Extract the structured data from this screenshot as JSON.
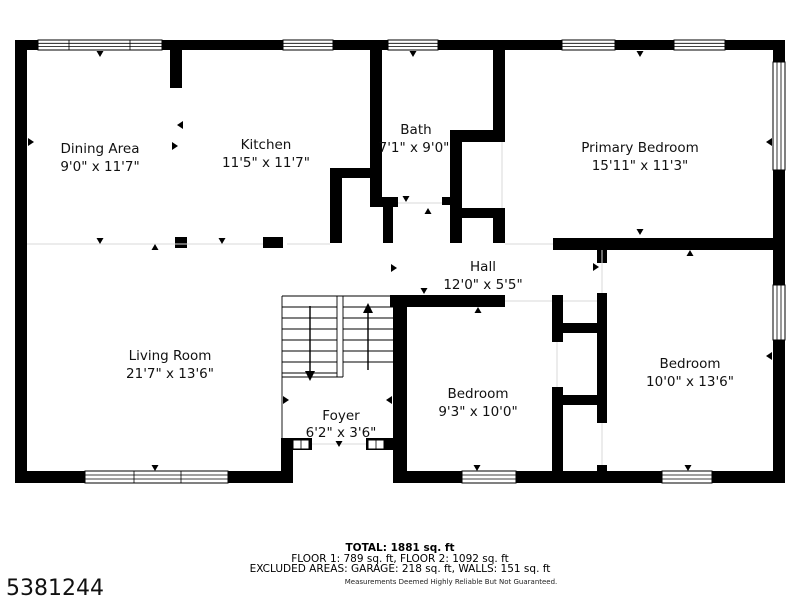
{
  "rooms": [
    {
      "name": "Dining Area",
      "dims": "9'0\" x 11'7\""
    },
    {
      "name": "Kitchen",
      "dims": "11'5\" x 11'7\""
    },
    {
      "name": "Bath",
      "dims": "7'1\" x 9'0\""
    },
    {
      "name": "Primary Bedroom",
      "dims": "15'11\" x 11'3\""
    },
    {
      "name": "Hall",
      "dims": "12'0\" x 5'5\""
    },
    {
      "name": "Living Room",
      "dims": "21'7\" x 13'6\""
    },
    {
      "name": "Foyer",
      "dims": "6'2\" x 3'6\""
    },
    {
      "name": "Bedroom",
      "dims": "9'3\" x 10'0\""
    },
    {
      "name": "Bedroom",
      "dims": "10'0\" x 13'6\""
    }
  ],
  "footer": {
    "total": "TOTAL: 1881 sq. ft",
    "floors": "FLOOR 1: 789 sq. ft, FLOOR 2: 1092 sq. ft",
    "excluded": "EXCLUDED AREAS: GARAGE: 218 sq. ft, WALLS: 151 sq. ft",
    "disclaimer": "Measurements Deemed Highly Reliable But Not Guaranteed."
  },
  "listing_id": "5381244",
  "colors": {
    "wall": "#000000",
    "background": "#ffffff",
    "text": "#111111"
  }
}
